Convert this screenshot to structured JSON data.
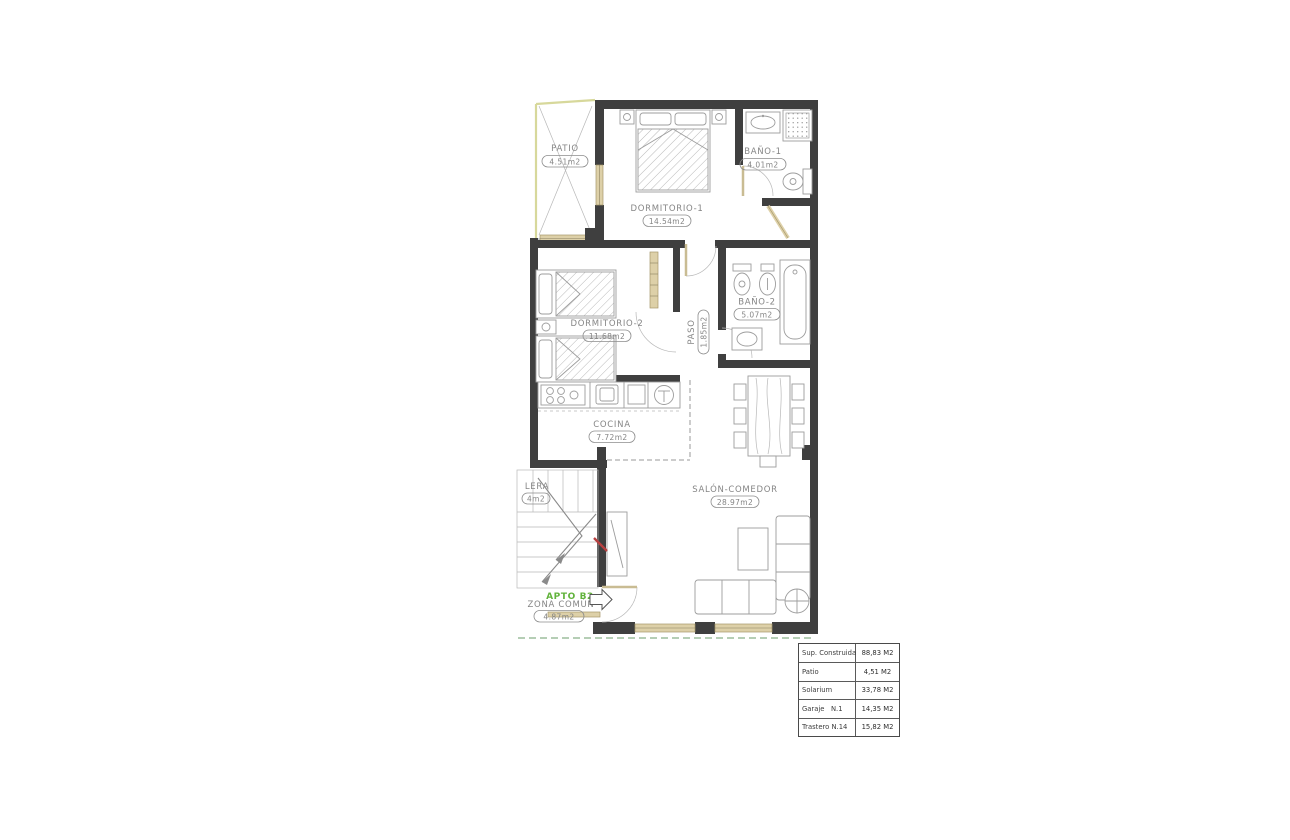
{
  "plan": {
    "rooms": [
      {
        "id": "patio",
        "name": "PATIO",
        "area": "4.51m2"
      },
      {
        "id": "dormitorio-1",
        "name": "DORMITORIO-1",
        "area": "14.54m2"
      },
      {
        "id": "bano-1",
        "name": "BAÑO-1",
        "area": "4.01m2"
      },
      {
        "id": "dormitorio-2",
        "name": "DORMITORIO-2",
        "area": "11.68m2"
      },
      {
        "id": "paso",
        "name": "PASO",
        "area": "1.85m2"
      },
      {
        "id": "bano-2",
        "name": "BAÑO-2",
        "area": "5.07m2"
      },
      {
        "id": "cocina",
        "name": "COCINA",
        "area": "7.72m2"
      },
      {
        "id": "salon-comedor",
        "name": "SALÓN-COMEDOR",
        "area": "28.97m2"
      },
      {
        "id": "escalera",
        "name": "LERA",
        "area": "4m2"
      },
      {
        "id": "zona-comun",
        "name": "ZONA COMÚN",
        "area": "4.87m2"
      }
    ],
    "apartment_tag": "APTO B2"
  },
  "summary_table": {
    "rows": [
      {
        "label": "Sup. Construida",
        "value": "88,83 M2"
      },
      {
        "label": "Patio",
        "value": "4,51 M2"
      },
      {
        "label": "Solarium",
        "value": "33,78 M2"
      },
      {
        "label": "Garaje   N.1",
        "value": "14,35 M2"
      },
      {
        "label": "Trastero N.14",
        "value": "15,82 M2"
      }
    ]
  },
  "colors": {
    "wall": "#3f3f3f",
    "carpentry_tan": "#ddd0a8",
    "patio_outline": "#d7d89b",
    "accent_green": "#62b33c",
    "section_red": "#b84040",
    "site_line_green": "#6b9c6b",
    "label_gray": "#858585"
  }
}
